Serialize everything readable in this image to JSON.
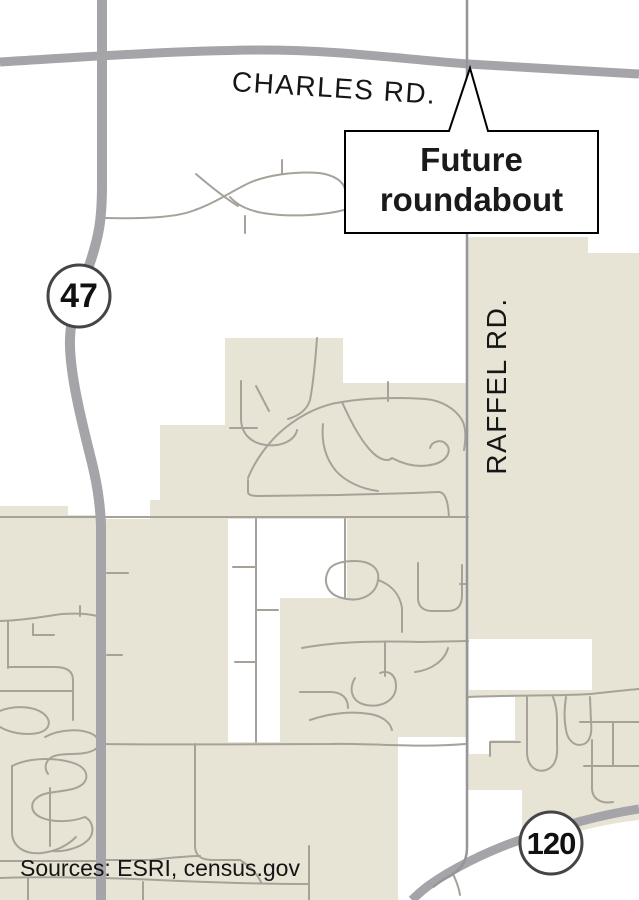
{
  "map": {
    "road_labels": {
      "charles": "CHARLES RD.",
      "raffel": "RAFFEL RD."
    },
    "shields": {
      "route47": "47",
      "route120": "120"
    },
    "callout": {
      "line1": "Future",
      "line2": "roundabout"
    },
    "attribution": "Sources: ESRI, census.gov",
    "colors": {
      "background": "#ffffff",
      "developed_area": "#e7e4d5",
      "street": "#a6a29a",
      "major_road": "#a5a5a9",
      "raffel_road": "#96969a",
      "shield_border": "#454545",
      "callout_border": "#000000",
      "label_text": "#161616"
    }
  }
}
